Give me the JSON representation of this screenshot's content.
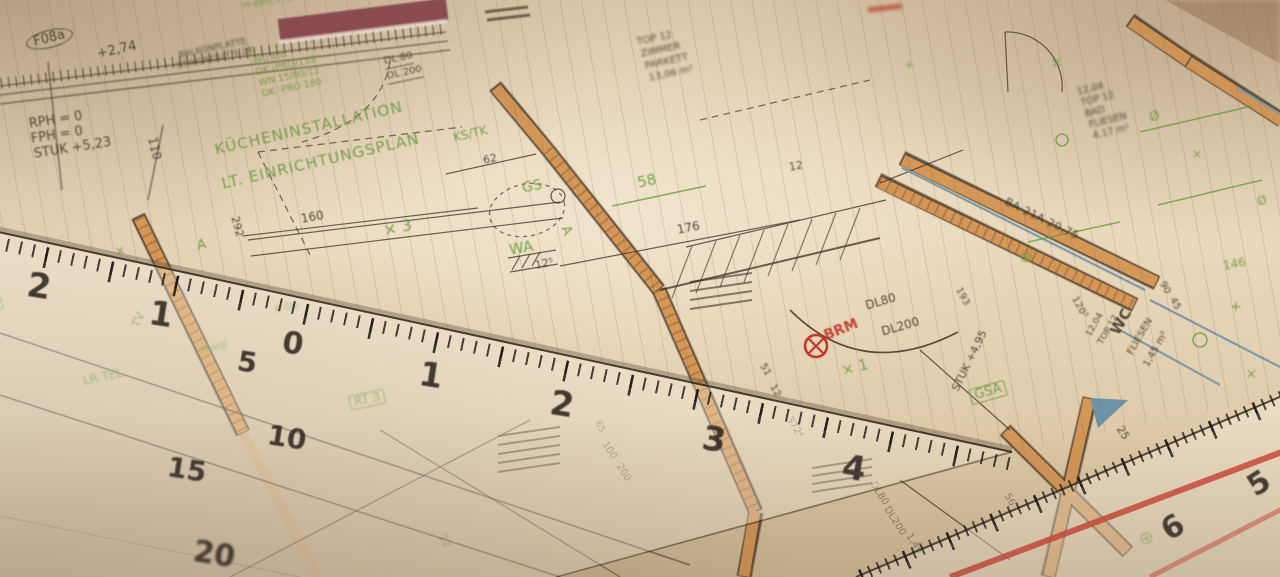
{
  "colors": {
    "paper": "#e9d8bc",
    "ink": "#46392b",
    "annotation_green": "#6e9c43",
    "wall_orange": "#d49757",
    "parapet_maroon": "#8c4a52",
    "mark_red": "#c5392e",
    "fixture_blue": "#7e9cab",
    "ruler_stripe_red": "#cf4a3c"
  },
  "plan": {
    "stamp": "F08a",
    "level": "+2,74",
    "balcony_note1": "BALKONPLATTE",
    "balcony_note2": "ST.MONOLIT S 28",
    "rail_green": "H-BML F-S",
    "rph": "RPH = 0",
    "fph": "FPH = 0",
    "stuk_523": "STUK +5,23",
    "spec_lines": [
      "WU 6/8",
      "DK -PRO/135",
      "WN 15/80/12",
      "DK -PRO 180"
    ],
    "door_dl80_top": "DL 80",
    "door_dl200_top": "DL 200",
    "room_zimmer": [
      "TOP 12",
      "ZIMMER",
      "PARKETT",
      "13,06 m²"
    ],
    "room_bad": [
      "12,04",
      "TOP 12",
      "BAD",
      "FLIESEN",
      "4,17 m²"
    ],
    "room_wc": [
      "12,04",
      "TOP 12",
      "WC",
      "FLIESEN",
      "1,45 m²"
    ],
    "title1": "KÜCHENINSTALLATION",
    "title2": "LT. EINRICHTUNGSPLAN",
    "ks_tk": "KS/TK",
    "gs": "GS",
    "wa": "WA",
    "a_left": "A",
    "a_mid": "A",
    "x3": "× 3",
    "x1": "× 1",
    "tv": "TV",
    "lr_tel": "LR TEL",
    "herd": "Herd",
    "e_du": "E-Du",
    "rt": "RT 3",
    "brm": "BRM",
    "dl80": "DL80",
    "dl200": "DL200",
    "dl80_b": "DL80",
    "dl200_b": "DL200",
    "stair_note": "1,49",
    "stuk_495": "STUK +4,95",
    "gsa": "GSA",
    "ba_wall": "BA 21A 20,75",
    "dims": {
      "d110": "110",
      "d160": "160",
      "d292": "292",
      "d62": "62",
      "d58": "58",
      "d176": "176",
      "d12s": "12⁵",
      "d12": "12",
      "d51": "51",
      "d12b": "12",
      "d193": "193",
      "d120": "120⁵",
      "d90": "90",
      "d45": "45",
      "d146": "146",
      "d25": "25",
      "d56": "56",
      "d372": "372⁴",
      "d22": "22",
      "d92": "92",
      "d65": "65",
      "d100": "100",
      "d200": "200"
    },
    "symbols": [
      "×",
      "⊕",
      "Ø",
      "+",
      "⊕",
      "×",
      "Ø",
      "+",
      "×",
      "×"
    ]
  },
  "setsquare": {
    "edge_numbers": [
      "2",
      "1",
      "0",
      "1",
      "2",
      "3",
      "4"
    ],
    "inner_numbers": [
      "5",
      "10",
      "15",
      "20"
    ]
  },
  "ruler2": {
    "numbers": [
      "6",
      "5"
    ]
  }
}
